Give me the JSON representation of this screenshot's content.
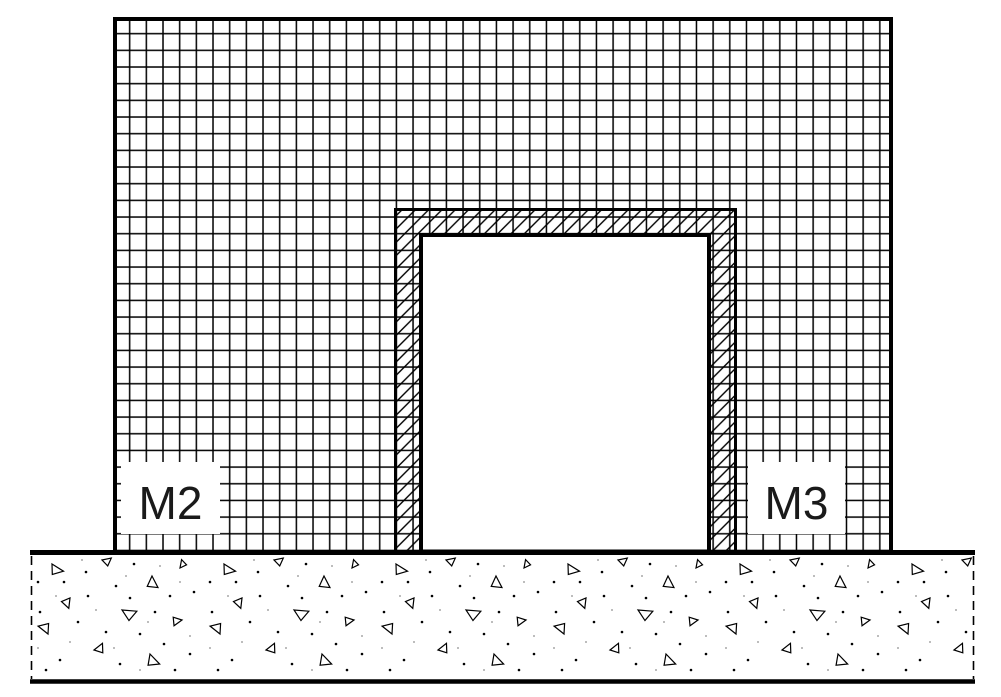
{
  "drawing": {
    "labels": {
      "left_wall": "M2",
      "right_wall": "M3"
    },
    "colors": {
      "line": "#000000",
      "background": "#ffffff",
      "speckle": "#a8a8a8"
    }
  }
}
